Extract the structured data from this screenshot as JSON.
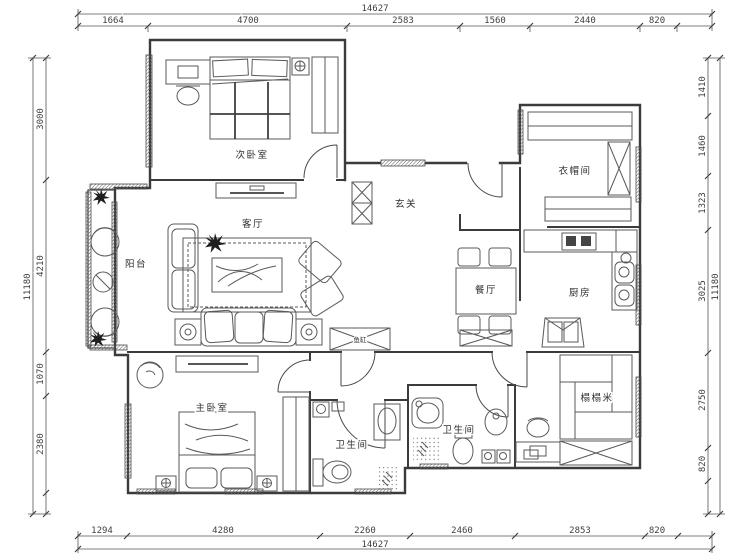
{
  "dimensions": {
    "top": {
      "total": "14627",
      "segments": [
        "1664",
        "4700",
        "2583",
        "1560",
        "2440",
        "820"
      ]
    },
    "bottom": {
      "total": "14627",
      "segments": [
        "1294",
        "4280",
        "2260",
        "2460",
        "2853",
        "820"
      ]
    },
    "left": {
      "total": "11180",
      "segments": [
        "3000",
        "4210",
        "1070",
        "2380"
      ]
    },
    "right": {
      "total": "11180",
      "segments": [
        "1410",
        "1460",
        "1323",
        "3025",
        "2750",
        "820"
      ]
    }
  },
  "rooms": {
    "secondary_bedroom": "次卧室",
    "living_room": "客厅",
    "balcony": "阳台",
    "foyer": "玄关",
    "cloakroom": "衣帽间",
    "dining_room": "餐厅",
    "kitchen": "厨房",
    "master_bedroom": "主卧室",
    "bathroom_1": "卫生间",
    "bathroom_2": "卫生间",
    "tatami_room": "榻榻米",
    "fish_tank": "鱼缸"
  },
  "colors": {
    "line": "#3b3b3b",
    "furniture_line": "#5a5a5a",
    "background": "#ffffff"
  }
}
